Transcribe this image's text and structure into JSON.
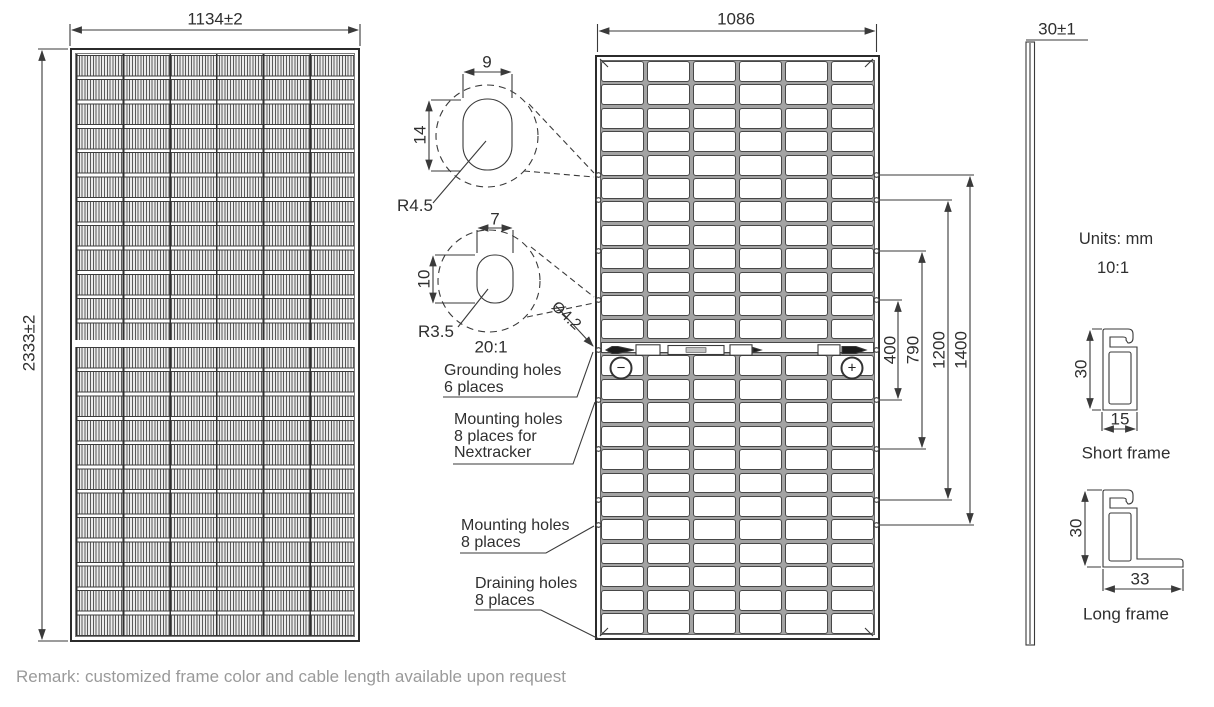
{
  "front_view": {
    "width_dim": "1134±2",
    "height_dim": "2333±2"
  },
  "back_view": {
    "width_dim": "1086",
    "spacing_dims": {
      "s400": "400",
      "s790": "790",
      "s1200": "1200",
      "s1400": "1400"
    },
    "negative_terminal": "−",
    "positive_terminal": "+"
  },
  "details": {
    "large_hole": {
      "width": "9",
      "height": "14",
      "radius": "R4.5"
    },
    "small_hole": {
      "width": "7",
      "height": "10",
      "radius": "R3.5",
      "scale": "20:1"
    },
    "hole_diameter": "Ø4.2"
  },
  "callouts": {
    "grounding": {
      "line1": "Grounding holes",
      "line2": "6 places"
    },
    "mounting_nextracker": {
      "line1": "Mounting holes",
      "line2": "8 places for",
      "line3": "Nextracker"
    },
    "mounting": {
      "line1": "Mounting holes",
      "line2": "8 places"
    },
    "draining": {
      "line1": "Draining holes",
      "line2": "8 places"
    }
  },
  "side_view": {
    "thickness_dim": "30±1"
  },
  "notes": {
    "units": "Units: mm",
    "scale": "10:1"
  },
  "frames": {
    "short": {
      "height": "30",
      "width": "15",
      "label": "Short frame"
    },
    "long": {
      "height": "30",
      "width": "33",
      "label": "Long frame"
    }
  },
  "remark": "Remark: customized frame color and cable length available upon request",
  "colors": {
    "line": "#3a3a3a",
    "remark_text": "#9a9a9a"
  }
}
